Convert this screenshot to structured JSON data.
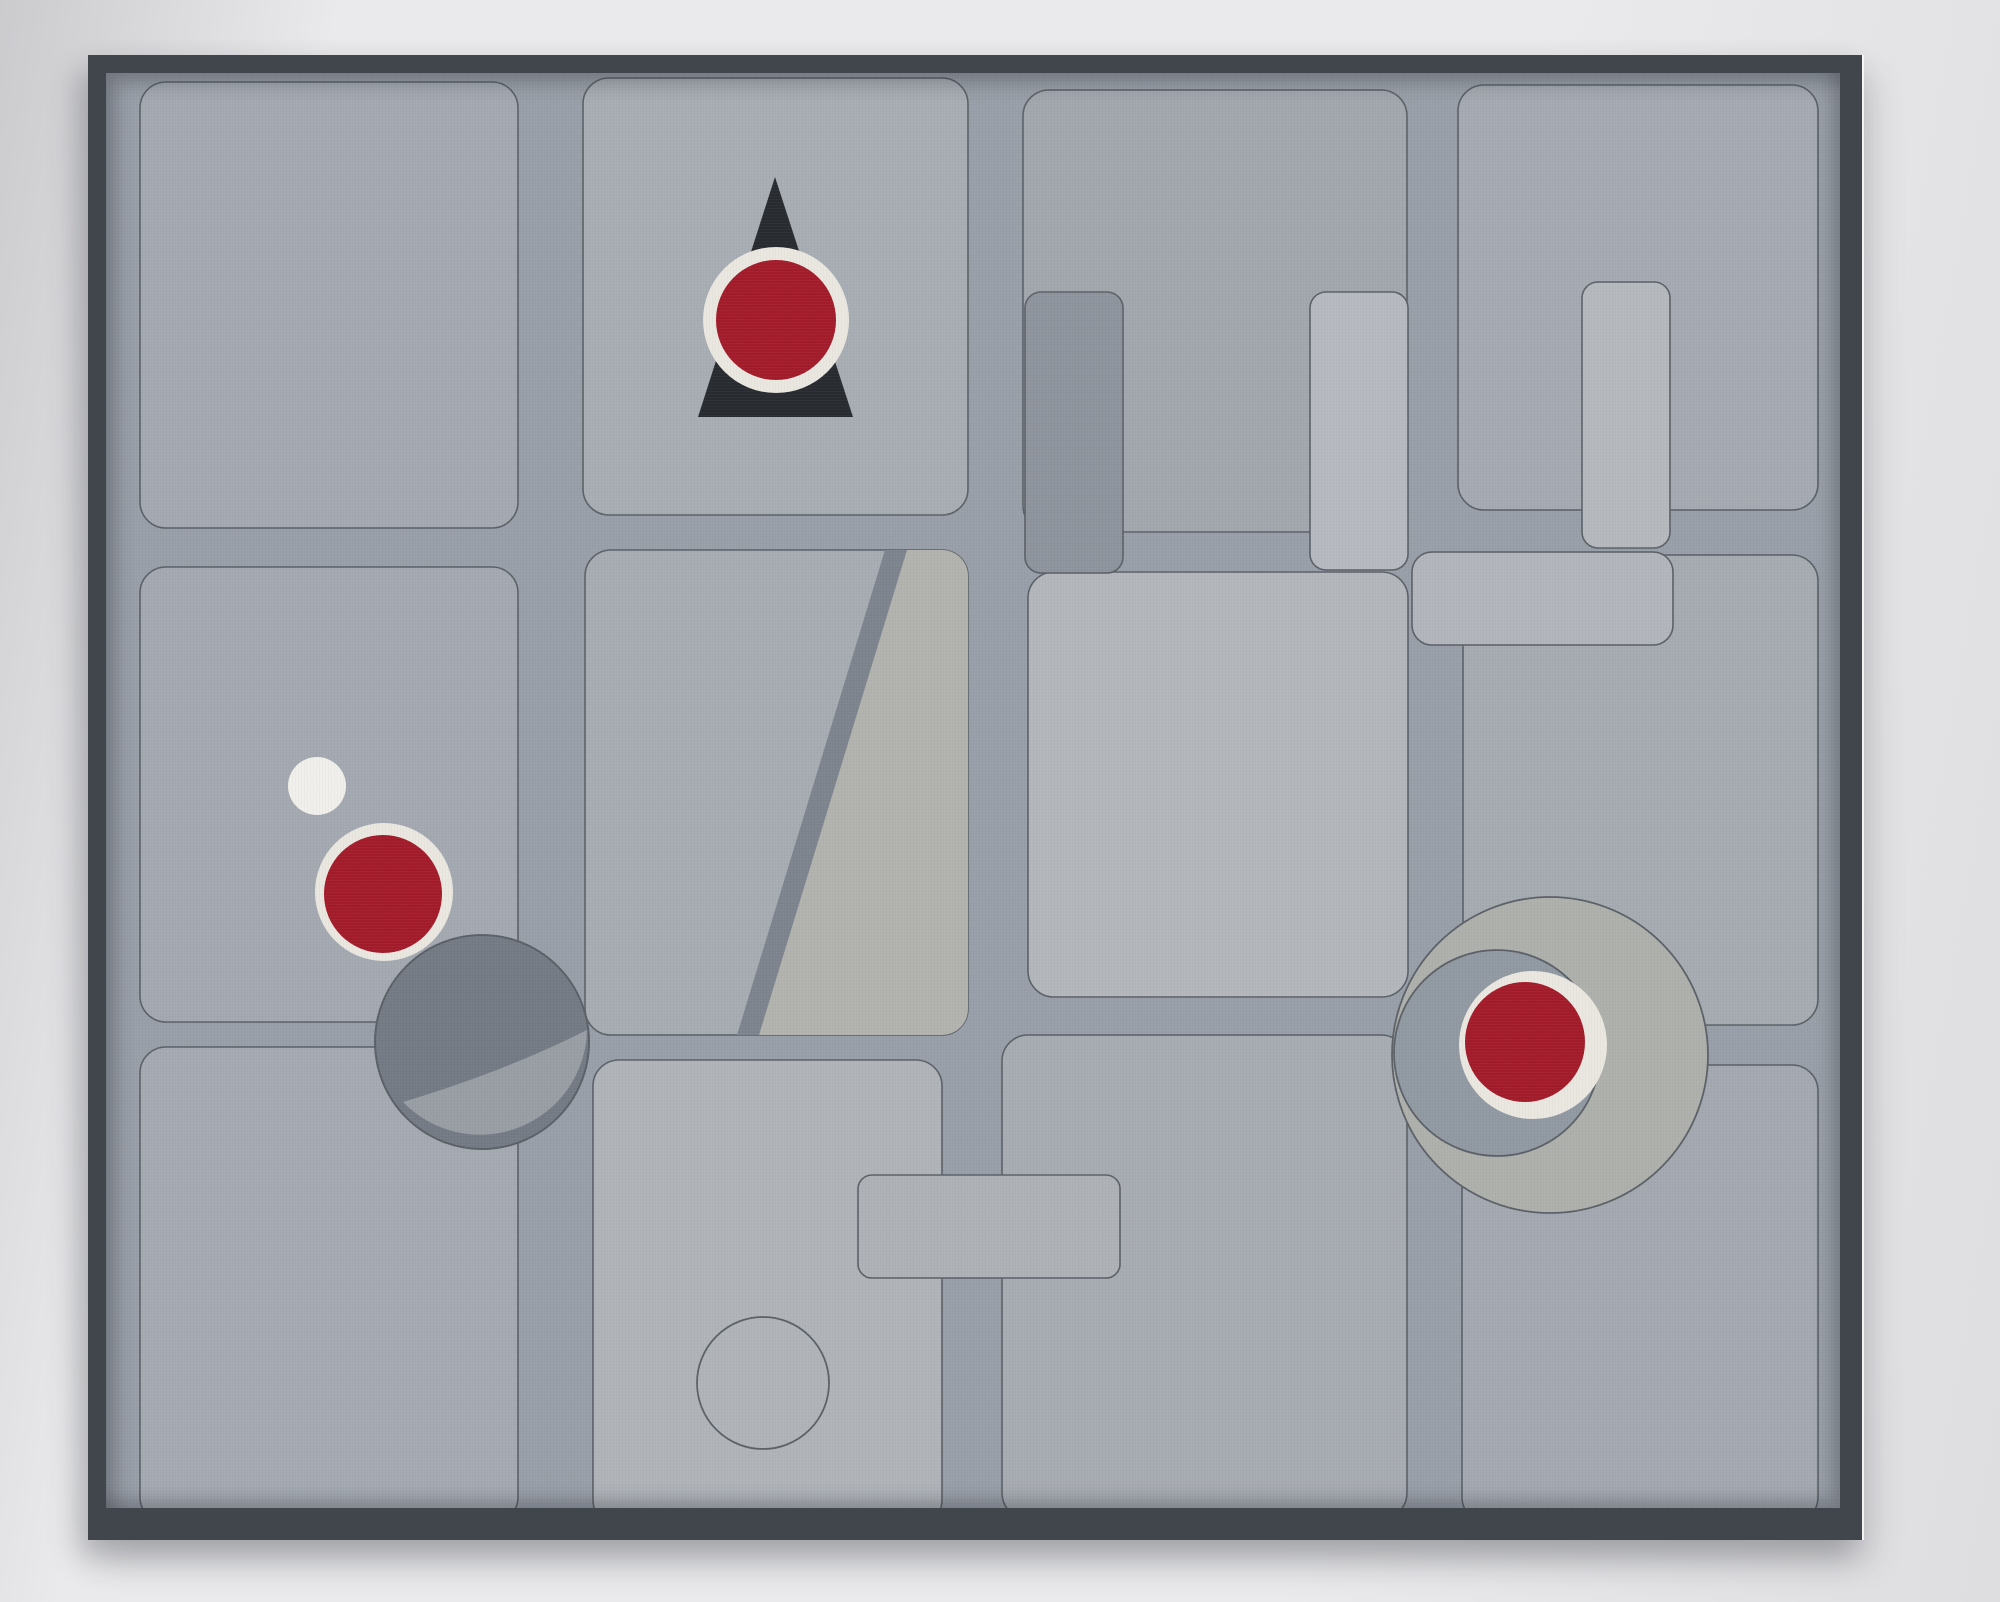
{
  "artwork": {
    "kind": "framed abstract geometric painting, photographed on a light gray wall",
    "composition": "4 columns x 3 rows of thin-outlined rounded-rectangle panels in close shades of gray",
    "elements": [
      "black triangle with red disc in cream ring, top of second column",
      "small white dot, left middle panel",
      "red disc in cream ring, left middle panel",
      "two-tone dark gray circle overlapping panel corner, lower left",
      "diagonal gray bar with lighter wedge, center-left middle panel",
      "dark gray vertical rectangle over third-column panel edge",
      "two light gray vertical rectangles, upper right area",
      "light gray horizontal rectangle, middle right",
      "light gray horizontal rectangle over bottom-center seam",
      "empty outlined circle, bottom-center panel",
      "large light circle + medium gray circle + red disc in cream ring, right side"
    ]
  },
  "colors": {
    "wall": "#eaeaec",
    "wall_shadow": "#cbcbce",
    "wall_dim": "#dedee0",
    "frame": "#41464c",
    "canvas_bg": "#999fa8",
    "outline": "#5c6168",
    "rect_dark": "#8e949d",
    "rect_light": "#b6b9bf",
    "rect_light2": "#b5b8bd",
    "rect_wide": "#b2b5bb",
    "rect_center": "#aeb1b6",
    "stripe_dark": "#7e848e",
    "stripe_light": "#b2b3ae",
    "circle_dark": "#757b84",
    "circle_dark_light": "#999ea5",
    "ring_white": "#eae7e0",
    "dot_white": "#f0efeb",
    "red": "#a31c2b",
    "triangle_dark": "#282c31",
    "big_circle": "#aeb0ac",
    "mid_circle": "#9199a2"
  },
  "panels": {
    "r1c1": "#a4a9b1",
    "r1c2": "#a8adb4",
    "r1c3": "#a2a7ae",
    "r1c4": "#a5aab2",
    "r2c1": "#a4a9b1",
    "r2c2": "#a7acb3",
    "r2c3": "#b3b6bb",
    "r2c4": "#a6abb2",
    "r3c1": "#a5aab2",
    "r3c2": "#b0b4b9",
    "r3c3": "#a7abb2",
    "r3c4": "#a4a9b1"
  }
}
